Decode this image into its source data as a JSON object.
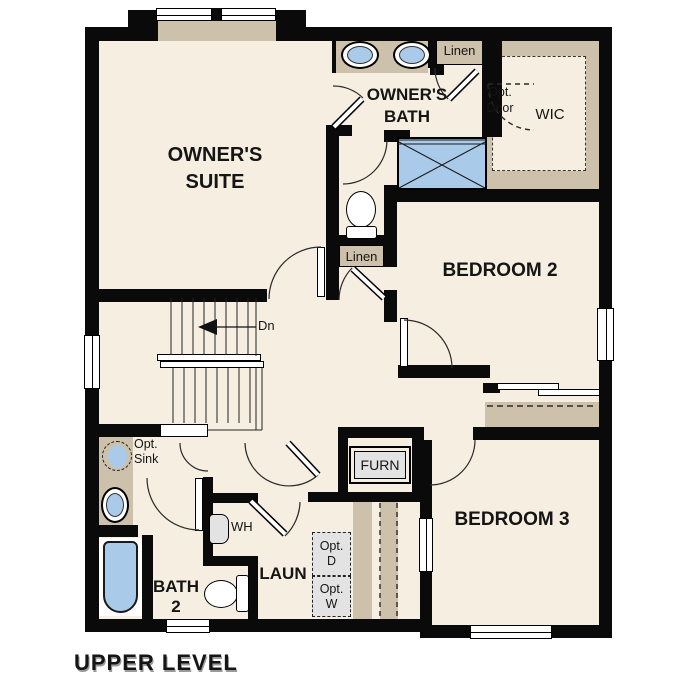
{
  "title": "UPPER LEVEL",
  "rooms": {
    "owners_suite": "OWNER'S\nSUITE",
    "owners_bath": "OWNER'S\nBATH",
    "bedroom_2": "BEDROOM 2",
    "bedroom_3": "BEDROOM 3",
    "bath_2": "BATH\n2",
    "laundry": "LAUN",
    "walk_in_closet": "WIC"
  },
  "labels": {
    "linen_top": "Linen",
    "linen_hall": "Linen",
    "opt_door": "Opt.\nDoor",
    "opt_sink": "Opt.\nSink",
    "water_heater": "WH",
    "furnace": "FURN",
    "opt_dryer": "Opt.\nD",
    "opt_washer": "Opt.\nW",
    "stairs_down": "Dn"
  },
  "colors": {
    "floor": "#f5eee1",
    "counter_tan": "#cdc1ab",
    "fixture_blue": "#a9cbe9",
    "wall_black": "#0a0a0a",
    "appliance_gray": "#e3e3e3",
    "line": "#2a2a2a"
  }
}
